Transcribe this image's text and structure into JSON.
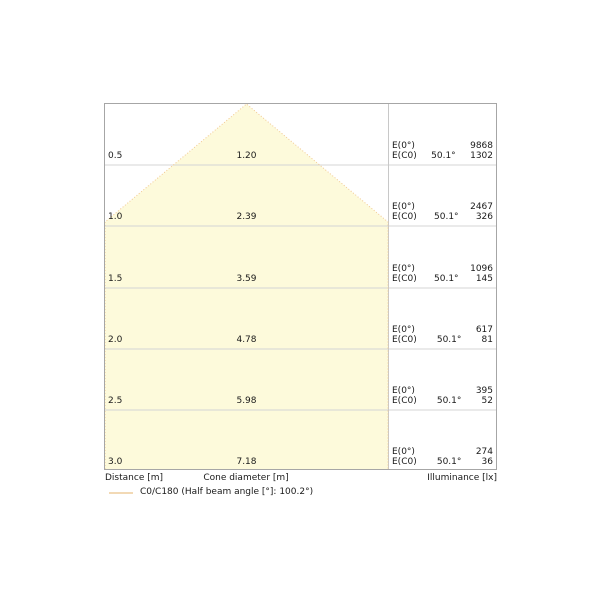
{
  "chart_data": {
    "type": "area",
    "subtype": "light-cone-diagram",
    "title": "",
    "xlabel": "Cone diameter [m]",
    "ylabel": "Distance [m]",
    "value_label": "Illuminance [lx]",
    "grid": true,
    "legend_position": "bottom-left",
    "distances_m": [
      0.5,
      1.0,
      1.5,
      2.0,
      2.5,
      3.0
    ],
    "cone_diameters_m": [
      1.2,
      2.39,
      3.59,
      4.78,
      5.98,
      7.18
    ],
    "series": [
      {
        "name": "E(0°) illuminance [lx]",
        "values": [
          9868,
          2467,
          1096,
          617,
          395,
          274
        ]
      },
      {
        "name": "E(C0) illuminance [lx]",
        "values": [
          1302,
          326,
          145,
          81,
          52,
          36
        ]
      }
    ],
    "beam_angle_per_row": "50.1°",
    "half_beam_angle_deg": 100.2,
    "legend": "C0/C180 (Half beam angle [°]: 100.2°)"
  },
  "labels": {
    "e0": "E(0°)",
    "ec0": "E(C0)"
  },
  "rows": [
    {
      "distance": "0.5",
      "diameter": "1.20",
      "e0": "9868",
      "angle": "50.1°",
      "ec0": "1302"
    },
    {
      "distance": "1.0",
      "diameter": "2.39",
      "e0": "2467",
      "angle": "50.1°",
      "ec0": "326"
    },
    {
      "distance": "1.5",
      "diameter": "3.59",
      "e0": "1096",
      "angle": "50.1°",
      "ec0": "145"
    },
    {
      "distance": "2.0",
      "diameter": "4.78",
      "e0": "617",
      "angle": "50.1°",
      "ec0": "81"
    },
    {
      "distance": "2.5",
      "diameter": "5.98",
      "e0": "395",
      "angle": "50.1°",
      "ec0": "52"
    },
    {
      "distance": "3.0",
      "diameter": "7.18",
      "e0": "274",
      "angle": "50.1°",
      "ec0": "36"
    }
  ],
  "footer": {
    "distance": "Distance [m]",
    "cone_diameter": "Cone diameter [m]",
    "illuminance": "Illuminance [lx]"
  },
  "legend": {
    "label": "C0/C180 (Half beam angle [°]: 100.2°)"
  },
  "colors": {
    "cone_fill": "#fdfadb",
    "cone_stroke": "#f2c994",
    "grid": "#d4d4d4",
    "divider": "#c8c8c8",
    "border": "#a6a6a6",
    "legend_swatch": "#f2d9b5"
  }
}
